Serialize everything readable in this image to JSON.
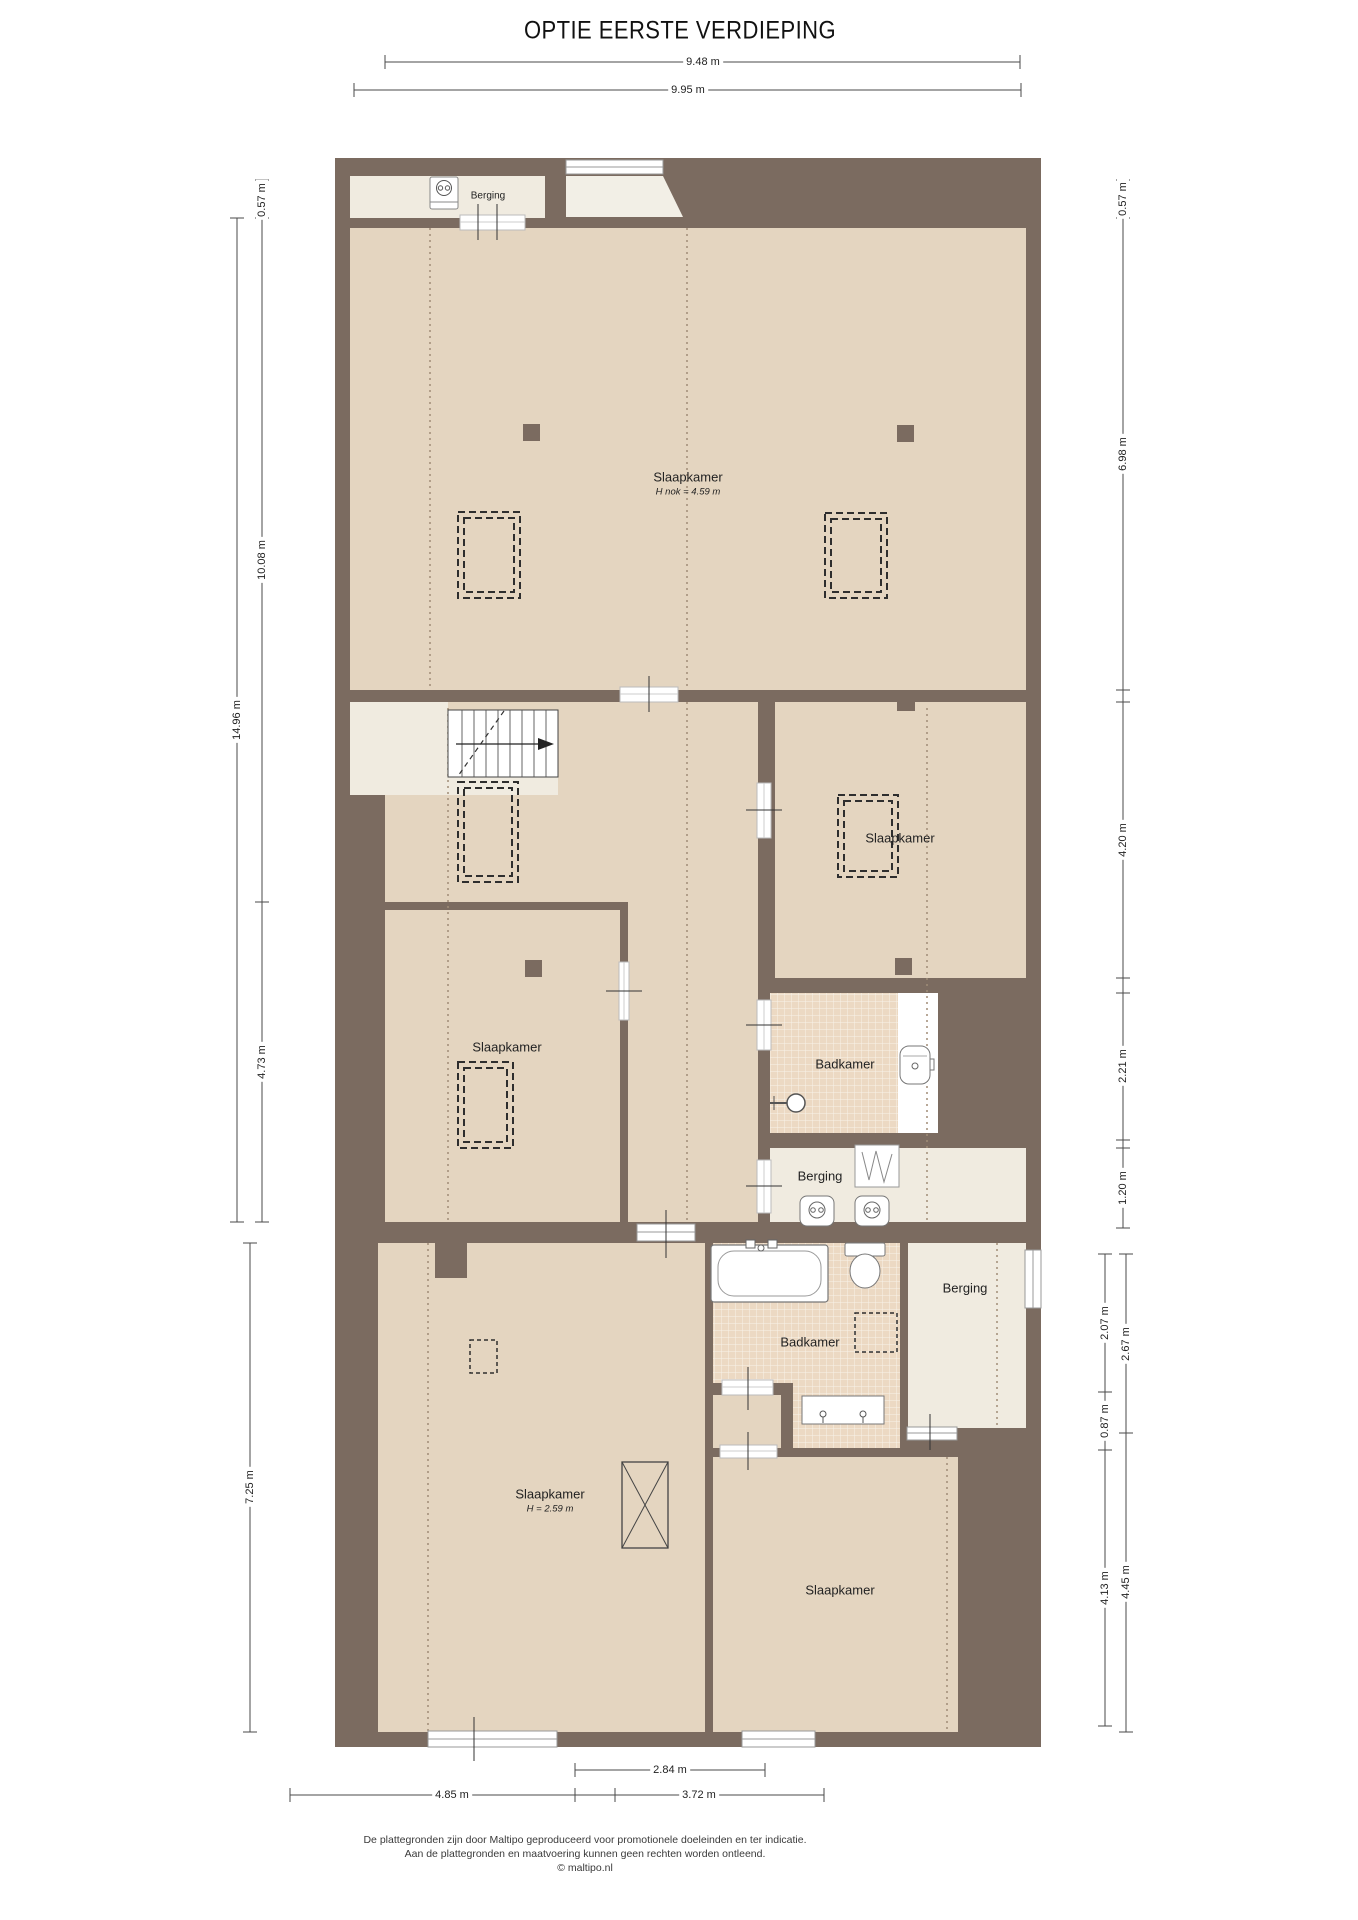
{
  "title": "OPTIE EERSTE VERDIEPING",
  "rooms": {
    "berging_top": "Berging",
    "slaapkamer_main": "Slaapkamer",
    "slaapkamer_main_sub": "H nok = 4.59 m",
    "slaapkamer_right": "Slaapkamer",
    "slaapkamer_middle": "Slaapkamer",
    "badkamer_middle": "Badkamer",
    "berging_middle": "Berging",
    "slaapkamer_bottom_left": "Slaapkamer",
    "slaapkamer_bottom_left_sub": "H = 2.59 m",
    "badkamer_bottom": "Badkamer",
    "berging_bottom": "Berging",
    "slaapkamer_bottom_right": "Slaapkamer"
  },
  "dims": {
    "top_inner": "9.48 m",
    "top_outer": "9.95 m",
    "left_top": "0.57 m",
    "left_main": "10.08 m",
    "left_total": "14.96 m",
    "left_mid": "4.73 m",
    "left_bottom": "7.25 m",
    "right_top": "0.57 m",
    "right_main": "6.98 m",
    "right_bed": "4.20 m",
    "right_bath": "2.21 m",
    "right_berging": "1.20 m",
    "right_b_207": "2.07 m",
    "right_b_267": "2.67 m",
    "right_b_087": "0.87 m",
    "right_b_413": "4.13 m",
    "right_b_445": "4.45 m",
    "bottom_left": "4.85 m",
    "bottom_mid": "2.84 m",
    "bottom_right": "3.72 m"
  },
  "footer": {
    "line1": "De plattegronden zijn door Maltipo geproduceerd voor promotionele doeleinden en ter indicatie.",
    "line2": "Aan de plattegronden en maatvoering kunnen geen rechten worden ontleend.",
    "line3": "© maltipo.nl"
  },
  "colors": {
    "wall": "#7b6b60",
    "floor": "#e4d5c0",
    "floor_light": "#f0ebe0",
    "tile": "#ecd9c3",
    "dimension_line": "#4a4a4a"
  },
  "icons": [
    "boiler-icon",
    "stairs-up-icon",
    "shower-icon",
    "washbasin-icon",
    "bathtub-icon",
    "toilet-icon",
    "double-washbasin-icon",
    "wardrobe-icon",
    "water-heater-icon",
    "shaft-cross-icon",
    "skylight-dashed-icon"
  ]
}
